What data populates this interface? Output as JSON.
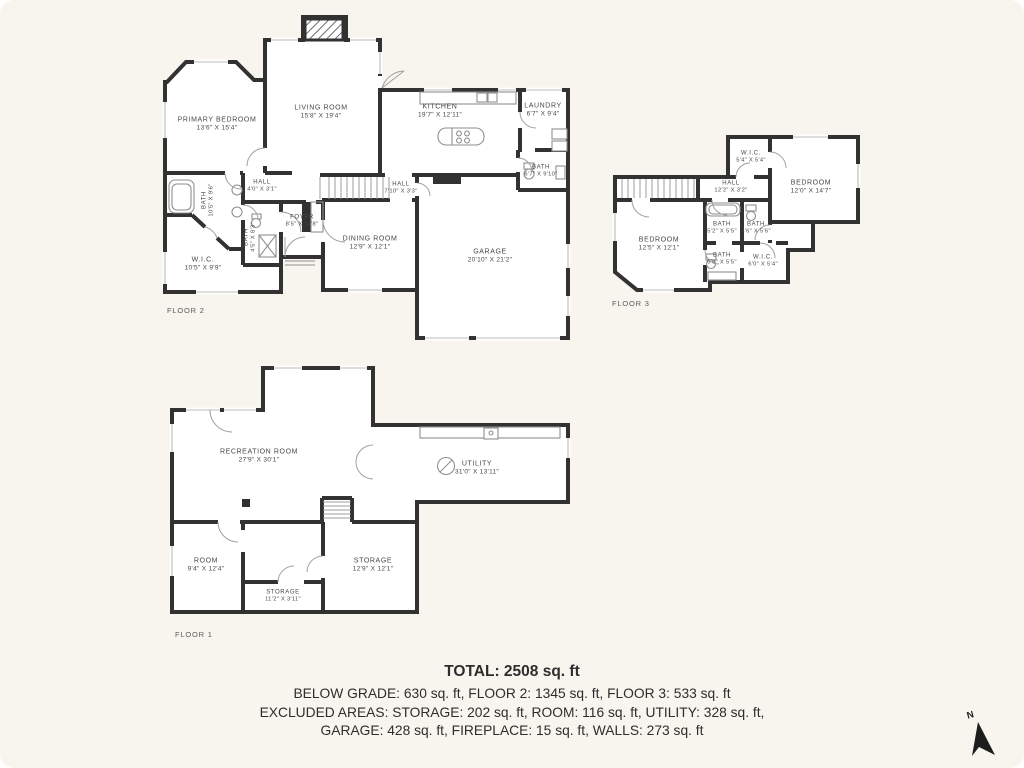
{
  "colors": {
    "background": "#f7f5ee",
    "wall": "#323232",
    "label_text": "#474747",
    "summary_text": "#2d2d2d"
  },
  "floor2": {
    "label": "FLOOR 2",
    "rooms": {
      "primary_bedroom": {
        "name": "PRIMARY BEDROOM",
        "dims": "13'6\" X 15'4\""
      },
      "living_room": {
        "name": "LIVING ROOM",
        "dims": "15'8\" X 19'4\""
      },
      "kitchen": {
        "name": "KITCHEN",
        "dims": "19'7\" X 12'11\""
      },
      "laundry": {
        "name": "LAUNDRY",
        "dims": "6'7\" X 9'4\""
      },
      "bath_right": {
        "name": "BATH",
        "dims": "6'7\" X 9'10\""
      },
      "hall_left": {
        "name": "HALL",
        "dims": "4'0\" X 3'1\""
      },
      "hall_right": {
        "name": "HALL",
        "dims": "7'10\" X 3'3\""
      },
      "bath_tub": {
        "name": "BATH",
        "dims": "10'5\" X 9'6\""
      },
      "bath_small": {
        "name": "BATH",
        "dims": "4'5\" X 8'3\""
      },
      "wic": {
        "name": "W.I.C.",
        "dims": "10'5\" X 9'9\""
      },
      "foyer": {
        "name": "FOYER",
        "dims": "8'5\" X 11'8\""
      },
      "dining_room": {
        "name": "DINING ROOM",
        "dims": "12'9\" X 12'1\""
      },
      "garage": {
        "name": "GARAGE",
        "dims": "20'10\" X 21'2\""
      }
    }
  },
  "floor3": {
    "label": "FLOOR 3",
    "rooms": {
      "wic_top": {
        "name": "W.I.C.",
        "dims": "5'4\" X 5'4\""
      },
      "bedroom_right": {
        "name": "BEDROOM",
        "dims": "12'0\" X 14'7\""
      },
      "hall": {
        "name": "HALL",
        "dims": "12'2\" X 3'2\""
      },
      "bath_left": {
        "name": "BATH",
        "dims": "5'2\" X 5'5\""
      },
      "bath_right": {
        "name": "BATH",
        "dims": "3'6\" X 5'6\""
      },
      "bedroom_left": {
        "name": "BEDROOM",
        "dims": "12'5\" X 12'1\""
      },
      "bath_bottom": {
        "name": "BATH",
        "dims": "5'6\" X 5'5\""
      },
      "wic_bottom": {
        "name": "W.I.C.",
        "dims": "6'0\" X 5'4\""
      }
    }
  },
  "floor1": {
    "label": "FLOOR 1",
    "rooms": {
      "recreation": {
        "name": "RECREATION ROOM",
        "dims": "27'9\" X 30'1\""
      },
      "utility": {
        "name": "UTILITY",
        "dims": "31'0\" X 13'11\""
      },
      "room": {
        "name": "ROOM",
        "dims": "9'4\" X 12'4\""
      },
      "storage_small": {
        "name": "STORAGE",
        "dims": "11'2\" X 3'11\""
      },
      "storage_large": {
        "name": "STORAGE",
        "dims": "12'9\" X 12'1\""
      }
    }
  },
  "summary": {
    "total": "TOTAL: 2508 sq. ft",
    "line2": "BELOW GRADE: 630 sq. ft, FLOOR 2: 1345 sq. ft, FLOOR 3: 533 sq. ft",
    "line3": "EXCLUDED AREAS: STORAGE: 202 sq. ft, ROOM: 116 sq. ft, UTILITY: 328 sq. ft,",
    "line4": "GARAGE: 428 sq. ft, FIREPLACE: 15 sq. ft, WALLS: 273 sq. ft"
  },
  "compass": {
    "label": "N"
  }
}
